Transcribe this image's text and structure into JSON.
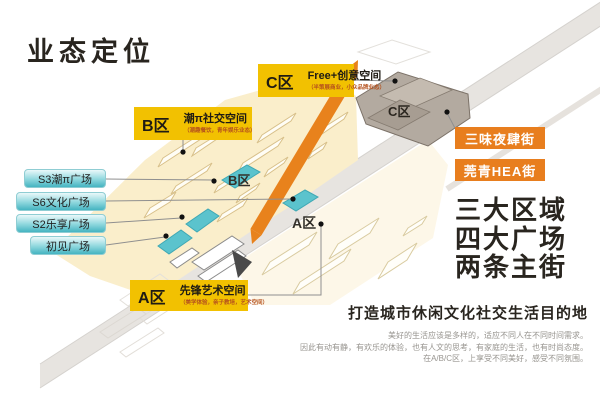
{
  "title": "业态定位",
  "map": {
    "zone_labels": {
      "c": {
        "zone": "C区",
        "name": "Free+创意空间",
        "sub": "（半策展商业，小众品牌业态）"
      },
      "b": {
        "zone": "B区",
        "name": "潮π社交空间",
        "sub": "（潮趣餐饮，青年娱乐业态）"
      },
      "a": {
        "zone": "A区",
        "name": "先锋艺术空间",
        "sub": "（美学体验，亲子教培，艺术空间）"
      }
    },
    "marks": {
      "a": "A区",
      "b": "B区",
      "c": "C区"
    },
    "plazas": [
      "S3潮π广场",
      "S6文化广场",
      "S2乐享广场",
      "初见广场"
    ],
    "streets": [
      "三味夜肆街",
      "莞青HEA街"
    ]
  },
  "summary": {
    "lines": [
      "三大区域",
      "四大广场",
      "两条主街"
    ]
  },
  "footer": {
    "heading": "打造城市休闲文化社交生活目的地",
    "paragraph": [
      "美好的生活应该是多样的，适应不同人在不同时间需求。",
      "因此有动有静，有欢乐的体验，也有人文的思考，有家庭的生活，也有时尚态度。",
      "在A/B/C区，上享受不同美好，感受不同氛围。"
    ]
  },
  "colors": {
    "accent_yellow": "#F2C101",
    "accent_orange": "#E87E1E",
    "accent_teal": "#5BC3CD",
    "site_cream": "#FAEECB",
    "text_dark": "#29251F"
  }
}
